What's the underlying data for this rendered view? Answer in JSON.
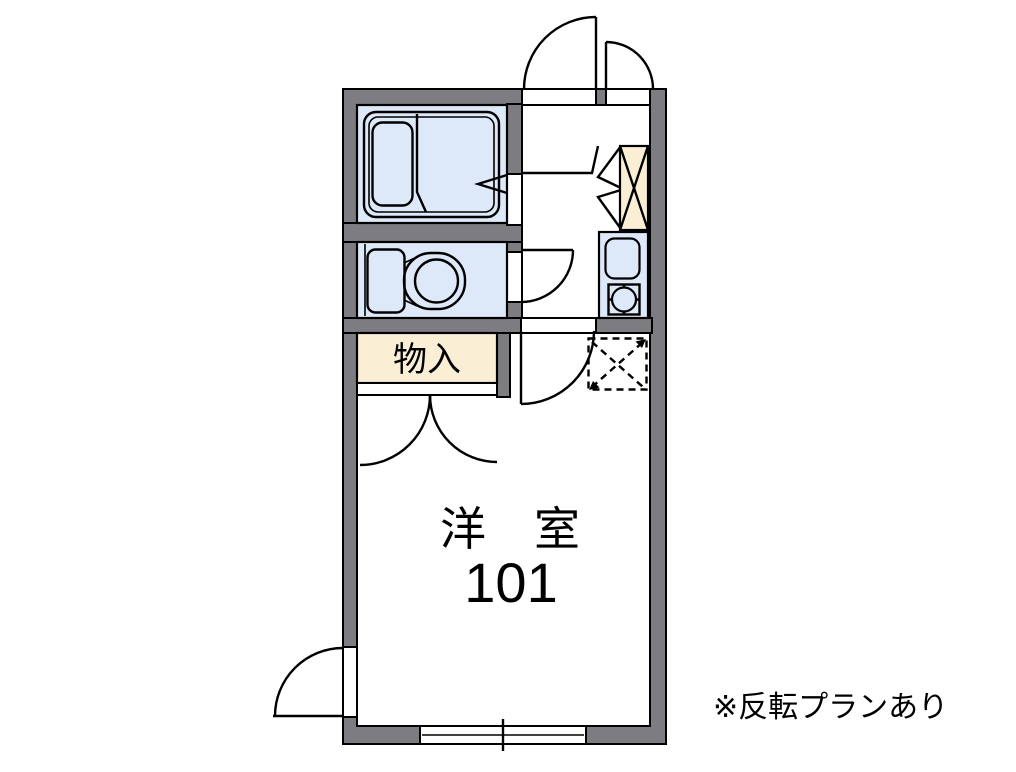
{
  "floorplan": {
    "note": "※反転プランあり",
    "rooms": {
      "storage": {
        "label": "物入"
      },
      "western_room": {
        "label": "洋室",
        "number": "101"
      }
    },
    "colors": {
      "wall": "#7c7c81",
      "water": "#dde8f8",
      "wood": "#faeed4",
      "line": "#000000",
      "background": "#ffffff"
    }
  }
}
